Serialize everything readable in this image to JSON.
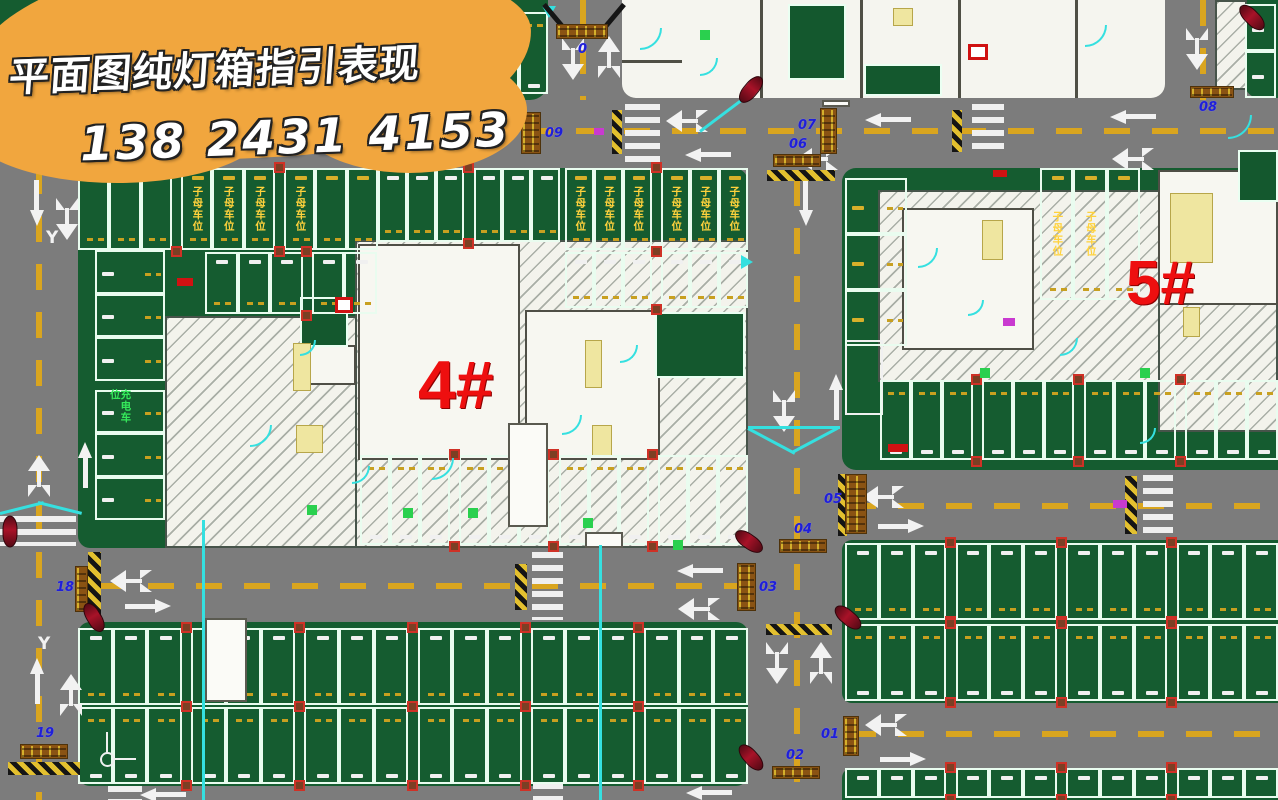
{
  "banner": {
    "line1": "平面图纯灯箱指引表现",
    "line2": "138 2431 4153"
  },
  "buildings": [
    {
      "label": "4#"
    },
    {
      "label": "5#"
    }
  ],
  "axis_label": "Y",
  "stall_tags": {
    "family": "子母车位",
    "charging": "充电车位"
  },
  "colors": {
    "road": "#7c7c7c",
    "parking_green": "#155c30",
    "stall_line": "#e9fcef",
    "lane_yellow": "#d9a51f",
    "banner_orange": "#f1a63e",
    "building_label_red": "#ee0f0f",
    "lightbox_brown": "#8a5313",
    "lightbox_number_blue": "#1f1fd8",
    "accent_cyan": "#35e0e0"
  },
  "lightboxes": [
    {
      "label": "09",
      "x": 521,
      "y": 112,
      "w": 20,
      "h": 42,
      "lx": 545,
      "ly": 126
    },
    {
      "label": "07",
      "x": 820,
      "y": 108,
      "w": 17,
      "h": 46,
      "lx": 798,
      "ly": 118
    },
    {
      "label": "06",
      "x": 773,
      "y": 154,
      "w": 48,
      "h": 13,
      "lx": 789,
      "ly": 137
    },
    {
      "label": "08",
      "x": 1190,
      "y": 86,
      "w": 44,
      "h": 12,
      "lx": 1199,
      "ly": 100
    },
    {
      "label": "05",
      "x": 845,
      "y": 474,
      "w": 22,
      "h": 60,
      "lx": 824,
      "ly": 492
    },
    {
      "label": "04",
      "x": 779,
      "y": 539,
      "w": 48,
      "h": 14,
      "lx": 794,
      "ly": 522
    },
    {
      "label": "03",
      "x": 737,
      "y": 563,
      "w": 19,
      "h": 48,
      "lx": 759,
      "ly": 580
    },
    {
      "label": "01",
      "x": 843,
      "y": 716,
      "w": 16,
      "h": 40,
      "lx": 821,
      "ly": 727
    },
    {
      "label": "02",
      "x": 772,
      "y": 766,
      "w": 48,
      "h": 13,
      "lx": 786,
      "ly": 748
    },
    {
      "label": "18",
      "x": 75,
      "y": 566,
      "w": 13,
      "h": 46,
      "lx": 56,
      "ly": 580
    },
    {
      "label": "19",
      "x": 20,
      "y": 744,
      "w": 48,
      "h": 15,
      "lx": 36,
      "ly": 726
    },
    {
      "label": "0",
      "x": 556,
      "y": 24,
      "w": 52,
      "h": 15,
      "lx": 578,
      "ly": 42
    }
  ],
  "scene": {
    "blocks": [
      {
        "x": 0,
        "y": 0,
        "w": 548,
        "h": 100,
        "r": "0 0 18px 0"
      },
      {
        "x": 1245,
        "y": 0,
        "w": 33,
        "h": 98,
        "r": "0 0 0 14px"
      },
      {
        "x": 78,
        "y": 168,
        "w": 670,
        "h": 380,
        "r": "16px 14px 12px 12px"
      },
      {
        "x": 842,
        "y": 168,
        "w": 436,
        "h": 302,
        "r": "14px 0 0 14px"
      },
      {
        "x": 78,
        "y": 622,
        "w": 670,
        "h": 164,
        "r": "12px 12px 12px 12px"
      },
      {
        "x": 842,
        "y": 540,
        "w": 436,
        "h": 163,
        "r": "10px 0 0 10px"
      },
      {
        "x": 842,
        "y": 768,
        "w": 436,
        "h": 32,
        "r": "10px 0 0 0"
      }
    ],
    "bldgzone": {
      "x": 622,
      "y": 0,
      "w": 543,
      "h": 98,
      "r": "0 0 14px 14px"
    },
    "hatches": [
      {
        "x": 165,
        "y": 316,
        "w": 212,
        "h": 232
      },
      {
        "x": 355,
        "y": 240,
        "w": 393,
        "h": 308
      },
      {
        "x": 878,
        "y": 190,
        "w": 400,
        "h": 192
      },
      {
        "x": 1158,
        "y": 190,
        "w": 120,
        "h": 242
      },
      {
        "x": 1215,
        "y": 0,
        "w": 32,
        "h": 90
      }
    ],
    "rooms_w": [
      {
        "x": 358,
        "y": 244,
        "w": 162,
        "h": 216
      },
      {
        "x": 525,
        "y": 310,
        "w": 135,
        "h": 150
      },
      {
        "x": 308,
        "y": 345,
        "w": 48,
        "h": 40
      },
      {
        "x": 902,
        "y": 208,
        "w": 132,
        "h": 142
      },
      {
        "x": 1158,
        "y": 170,
        "w": 120,
        "h": 135
      }
    ],
    "rooms_g": [
      {
        "x": 300,
        "y": 297,
        "w": 48,
        "h": 50
      },
      {
        "x": 655,
        "y": 312,
        "w": 90,
        "h": 66
      },
      {
        "x": 788,
        "y": 4,
        "w": 58,
        "h": 76
      },
      {
        "x": 864,
        "y": 64,
        "w": 78,
        "h": 32
      },
      {
        "x": 1238,
        "y": 150,
        "w": 40,
        "h": 52
      }
    ],
    "rooms_o": [
      {
        "x": 845,
        "y": 340,
        "w": 38,
        "h": 75
      }
    ],
    "boxes": [
      {
        "x": 205,
        "y": 618,
        "w": 42,
        "h": 84
      },
      {
        "x": 508,
        "y": 423,
        "w": 40,
        "h": 104
      },
      {
        "x": 585,
        "y": 532,
        "w": 38,
        "h": 16
      },
      {
        "x": 822,
        "y": 100,
        "w": 28,
        "h": 7
      }
    ],
    "shafts": [
      {
        "x": 293,
        "y": 343,
        "w": 18,
        "h": 48
      },
      {
        "x": 296,
        "y": 425,
        "w": 27,
        "h": 28
      },
      {
        "x": 585,
        "y": 340,
        "w": 17,
        "h": 48
      },
      {
        "x": 592,
        "y": 425,
        "w": 20,
        "h": 32
      },
      {
        "x": 982,
        "y": 220,
        "w": 21,
        "h": 40
      },
      {
        "x": 1170,
        "y": 193,
        "w": 43,
        "h": 70
      },
      {
        "x": 1183,
        "y": 307,
        "w": 17,
        "h": 30
      },
      {
        "x": 893,
        "y": 8,
        "w": 20,
        "h": 18
      }
    ],
    "walls": [
      {
        "x": 760,
        "y": 0,
        "w": 3,
        "h": 98
      },
      {
        "x": 860,
        "y": 0,
        "w": 3,
        "h": 98
      },
      {
        "x": 958,
        "y": 0,
        "w": 3,
        "h": 98
      },
      {
        "x": 1075,
        "y": 0,
        "w": 3,
        "h": 98
      },
      {
        "x": 622,
        "y": 60,
        "w": 60,
        "h": 3
      }
    ],
    "rows": [
      {
        "x": 200,
        "y": 12,
        "w": 348,
        "h": 84,
        "n": 11,
        "numAt": "bottom",
        "dashAt": "top",
        "numColor": "white"
      },
      {
        "x": 78,
        "y": 168,
        "w": 300,
        "h": 84,
        "n": 9,
        "numAt": "top",
        "dashAt": "bottom",
        "numColor": "yellow",
        "family": [
          4,
          5,
          6,
          7
        ]
      },
      {
        "x": 378,
        "y": 168,
        "w": 182,
        "h": 76,
        "n": 6,
        "numAt": "top",
        "dashAt": "bottom",
        "numColor": "white"
      },
      {
        "x": 565,
        "y": 168,
        "w": 183,
        "h": 84,
        "n": 6,
        "numAt": "top",
        "dashAt": "bottom",
        "numColor": "yellow",
        "family": [
          1,
          2,
          3,
          4,
          5,
          6
        ]
      },
      {
        "x": 205,
        "y": 252,
        "w": 172,
        "h": 64,
        "n": 5,
        "numAt": "top",
        "dashAt": "bottom",
        "numColor": "white"
      },
      {
        "x": 565,
        "y": 252,
        "w": 183,
        "h": 58,
        "n": 6,
        "numAt": "top",
        "dashAt": "bottom",
        "numColor": "white"
      },
      {
        "x": 95,
        "y": 250,
        "w": 72,
        "h": 270,
        "n": 6,
        "horiz": true,
        "numAt": "left",
        "dashAt": "right",
        "numColor": "white",
        "charging": 4
      },
      {
        "x": 360,
        "y": 455,
        "w": 388,
        "h": 92,
        "n": 12,
        "numAt": "bottom",
        "dashAt": "top",
        "numColor": "white"
      },
      {
        "x": 1245,
        "y": 4,
        "w": 33,
        "h": 94,
        "n": 2,
        "horiz": true,
        "numAt": "left",
        "numColor": "white"
      },
      {
        "x": 845,
        "y": 178,
        "w": 64,
        "h": 168,
        "n": 3,
        "horiz": true,
        "numAt": "left",
        "dashAt": "right",
        "numColor": "yellow"
      },
      {
        "x": 1040,
        "y": 168,
        "w": 100,
        "h": 134,
        "n": 3,
        "numAt": "top",
        "dashAt": "bottom",
        "numColor": "yellow",
        "family": [
          1,
          2
        ]
      },
      {
        "x": 880,
        "y": 380,
        "w": 398,
        "h": 82,
        "n": 12,
        "numAt": "bottom",
        "dashAt": "top",
        "numColor": "white"
      },
      {
        "x": 845,
        "y": 543,
        "w": 433,
        "h": 79,
        "n": 12,
        "numAt": "top",
        "dashAt": "bottom",
        "numColor": "white"
      },
      {
        "x": 845,
        "y": 624,
        "w": 433,
        "h": 79,
        "n": 12,
        "numAt": "bottom",
        "dashAt": "top",
        "numColor": "white"
      },
      {
        "x": 845,
        "y": 768,
        "w": 433,
        "h": 32,
        "n": 12,
        "numAt": "top",
        "numColor": "white"
      },
      {
        "x": 78,
        "y": 628,
        "w": 670,
        "h": 79,
        "n": 18,
        "numAt": "top",
        "dashAt": "bottom",
        "numColor": "white"
      },
      {
        "x": 78,
        "y": 707,
        "w": 670,
        "h": 79,
        "n": 18,
        "numAt": "bottom",
        "dashAt": "top",
        "numColor": "white"
      }
    ],
    "zebras": [
      {
        "x": 418,
        "y": 104,
        "w": 32,
        "h": 58
      },
      {
        "x": 625,
        "y": 104,
        "w": 35,
        "h": 58
      },
      {
        "x": 972,
        "y": 104,
        "w": 32,
        "h": 52
      },
      {
        "x": 532,
        "y": 552,
        "w": 31,
        "h": 68
      },
      {
        "x": 1143,
        "y": 475,
        "w": 30,
        "h": 60
      },
      {
        "x": 533,
        "y": 783,
        "w": 30,
        "h": 17
      },
      {
        "x": 108,
        "y": 786,
        "w": 34,
        "h": 14
      },
      {
        "x": 0,
        "y": 516,
        "w": 76,
        "h": 30
      }
    ],
    "bumps": [
      {
        "x": 88,
        "y": 552,
        "w": 13,
        "h": 66
      },
      {
        "x": 8,
        "y": 762,
        "w": 72,
        "h": 13
      },
      {
        "x": 766,
        "y": 624,
        "w": 66,
        "h": 11
      },
      {
        "x": 767,
        "y": 170,
        "w": 68,
        "h": 11
      },
      {
        "x": 838,
        "y": 474,
        "w": 9,
        "h": 62
      },
      {
        "x": 612,
        "y": 110,
        "w": 10,
        "h": 44
      },
      {
        "x": 952,
        "y": 110,
        "w": 10,
        "h": 42
      },
      {
        "x": 1125,
        "y": 476,
        "w": 12,
        "h": 58
      },
      {
        "x": 515,
        "y": 564,
        "w": 12,
        "h": 46
      }
    ],
    "dashes": [
      {
        "x": 0,
        "y": 128,
        "w": 1278,
        "h": 6,
        "v": false
      },
      {
        "x": 36,
        "y": 168,
        "w": 6,
        "h": 632,
        "v": true
      },
      {
        "x": 794,
        "y": 180,
        "w": 6,
        "h": 620,
        "v": true
      },
      {
        "x": 100,
        "y": 583,
        "w": 648,
        "h": 6,
        "v": false
      },
      {
        "x": 850,
        "y": 503,
        "w": 428,
        "h": 6,
        "v": false
      },
      {
        "x": 850,
        "y": 731,
        "w": 428,
        "h": 6,
        "v": false
      },
      {
        "x": 580,
        "y": 0,
        "w": 6,
        "h": 100,
        "v": true
      },
      {
        "x": 1200,
        "y": 0,
        "w": 6,
        "h": 100,
        "v": true
      }
    ],
    "arrows": [
      {
        "t": "p",
        "x": 14,
        "y": 196,
        "r": 90
      },
      {
        "t": "o",
        "x": 56,
        "y": 198,
        "r": 180
      },
      {
        "t": "o",
        "x": 28,
        "y": 455,
        "r": 0
      },
      {
        "t": "p",
        "x": 62,
        "y": 458,
        "r": -90
      },
      {
        "t": "p",
        "x": 14,
        "y": 674,
        "r": -90
      },
      {
        "t": "o",
        "x": 60,
        "y": 674,
        "r": 0
      },
      {
        "t": "o",
        "x": 120,
        "y": 560,
        "r": -90
      },
      {
        "t": "p",
        "x": 125,
        "y": 599,
        "r": 0
      },
      {
        "t": "p",
        "x": 677,
        "y": 564,
        "r": 180
      },
      {
        "t": "o",
        "x": 688,
        "y": 588,
        "r": -90
      },
      {
        "t": "o",
        "x": 676,
        "y": 100,
        "r": -90
      },
      {
        "t": "p",
        "x": 685,
        "y": 148,
        "r": 180
      },
      {
        "t": "o",
        "x": 806,
        "y": 138,
        "r": -90
      },
      {
        "t": "p",
        "x": 865,
        "y": 113,
        "r": 180
      },
      {
        "t": "p",
        "x": 1110,
        "y": 110,
        "r": 180
      },
      {
        "t": "o",
        "x": 1122,
        "y": 138,
        "r": -90
      },
      {
        "t": "p",
        "x": 783,
        "y": 196,
        "r": 90
      },
      {
        "t": "o",
        "x": 773,
        "y": 390,
        "r": 180
      },
      {
        "t": "p",
        "x": 813,
        "y": 390,
        "r": -90
      },
      {
        "t": "o",
        "x": 766,
        "y": 642,
        "r": 180
      },
      {
        "t": "o",
        "x": 810,
        "y": 642,
        "r": 0
      },
      {
        "t": "o",
        "x": 872,
        "y": 476,
        "r": -90
      },
      {
        "t": "p",
        "x": 878,
        "y": 519,
        "r": 0
      },
      {
        "t": "o",
        "x": 875,
        "y": 704,
        "r": -90
      },
      {
        "t": "p",
        "x": 880,
        "y": 752,
        "r": 0
      },
      {
        "t": "o",
        "x": 562,
        "y": 38,
        "r": 180
      },
      {
        "t": "o",
        "x": 598,
        "y": 36,
        "r": 0
      },
      {
        "t": "o",
        "x": 1186,
        "y": 28,
        "r": 180
      },
      {
        "t": "p",
        "x": 686,
        "y": 786,
        "r": 180
      },
      {
        "t": "p",
        "x": 140,
        "y": 788,
        "r": 180
      }
    ],
    "cars": [
      {
        "x": 735,
        "y": 82,
        "r": 130
      },
      {
        "x": 1236,
        "y": 10,
        "r": 45
      },
      {
        "x": 733,
        "y": 534,
        "r": 35
      },
      {
        "x": 832,
        "y": 610,
        "r": 40
      },
      {
        "x": 78,
        "y": 610,
        "r": 60
      },
      {
        "x": -6,
        "y": 524,
        "r": 90
      },
      {
        "x": 735,
        "y": 750,
        "r": 48
      }
    ],
    "cyanlines": [
      {
        "x": 202,
        "y": 520,
        "w": 3,
        "h": 280,
        "r": 0
      },
      {
        "x": 599,
        "y": 545,
        "w": 3,
        "h": 255,
        "r": 0
      },
      {
        "x": 748,
        "y": 426,
        "w": 92,
        "h": 3,
        "r": 0
      },
      {
        "x": 748,
        "y": 427,
        "w": 53,
        "h": 3,
        "r": 28
      },
      {
        "x": 792,
        "y": 451,
        "w": 52,
        "h": 3,
        "r": -28
      },
      {
        "x": 0,
        "y": 512,
        "w": 45,
        "h": 3,
        "r": -14
      },
      {
        "x": 38,
        "y": 501,
        "w": 45,
        "h": 3,
        "r": 14
      },
      {
        "x": 700,
        "y": 130,
        "w": 62,
        "h": 3,
        "r": -37
      }
    ],
    "arcs": [
      {
        "x": 640,
        "y": 28,
        "s": 20
      },
      {
        "x": 700,
        "y": 58,
        "s": 16
      },
      {
        "x": 1085,
        "y": 25,
        "s": 20
      },
      {
        "x": 250,
        "y": 425,
        "s": 20
      },
      {
        "x": 352,
        "y": 466,
        "s": 16
      },
      {
        "x": 432,
        "y": 458,
        "s": 20
      },
      {
        "x": 562,
        "y": 415,
        "s": 18
      },
      {
        "x": 620,
        "y": 345,
        "s": 16
      },
      {
        "x": 918,
        "y": 248,
        "s": 18
      },
      {
        "x": 1060,
        "y": 338,
        "s": 16
      },
      {
        "x": 1228,
        "y": 115,
        "s": 22
      },
      {
        "x": 1140,
        "y": 428,
        "s": 14
      },
      {
        "x": 968,
        "y": 300,
        "s": 14
      },
      {
        "x": 300,
        "y": 340,
        "s": 14
      }
    ],
    "tris": [
      {
        "x": 741,
        "y": 255,
        "d": "right"
      },
      {
        "x": 542,
        "y": 6,
        "d": "down"
      }
    ],
    "gantry": [
      {
        "x": 544,
        "y": 2,
        "w": 36,
        "r": 50
      },
      {
        "x": 624,
        "y": 2,
        "w": 36,
        "r": 130
      }
    ],
    "marks_red": [
      {
        "x": 177,
        "y": 278,
        "w": 16,
        "h": 8
      },
      {
        "x": 888,
        "y": 444,
        "w": 20,
        "h": 8
      },
      {
        "x": 993,
        "y": 170,
        "w": 14,
        "h": 7
      }
    ],
    "redboxes": [
      {
        "x": 335,
        "y": 297,
        "w": 18,
        "h": 16
      },
      {
        "x": 968,
        "y": 44,
        "w": 20,
        "h": 16
      }
    ],
    "magenta": [
      {
        "x": 594,
        "y": 128,
        "w": 10,
        "h": 7
      },
      {
        "x": 1113,
        "y": 500,
        "w": 14,
        "h": 8
      },
      {
        "x": 1003,
        "y": 318,
        "w": 12,
        "h": 8
      }
    ],
    "doors": [
      {
        "x": 307,
        "y": 505
      },
      {
        "x": 403,
        "y": 508
      },
      {
        "x": 468,
        "y": 508
      },
      {
        "x": 583,
        "y": 518
      },
      {
        "x": 673,
        "y": 540
      },
      {
        "x": 980,
        "y": 368
      },
      {
        "x": 1140,
        "y": 368
      },
      {
        "x": 700,
        "y": 30
      }
    ],
    "axis": [
      {
        "x": 38,
        "y": 634
      },
      {
        "x": 46,
        "y": 228
      }
    ],
    "ucs": {
      "x": 100,
      "y": 752
    }
  }
}
